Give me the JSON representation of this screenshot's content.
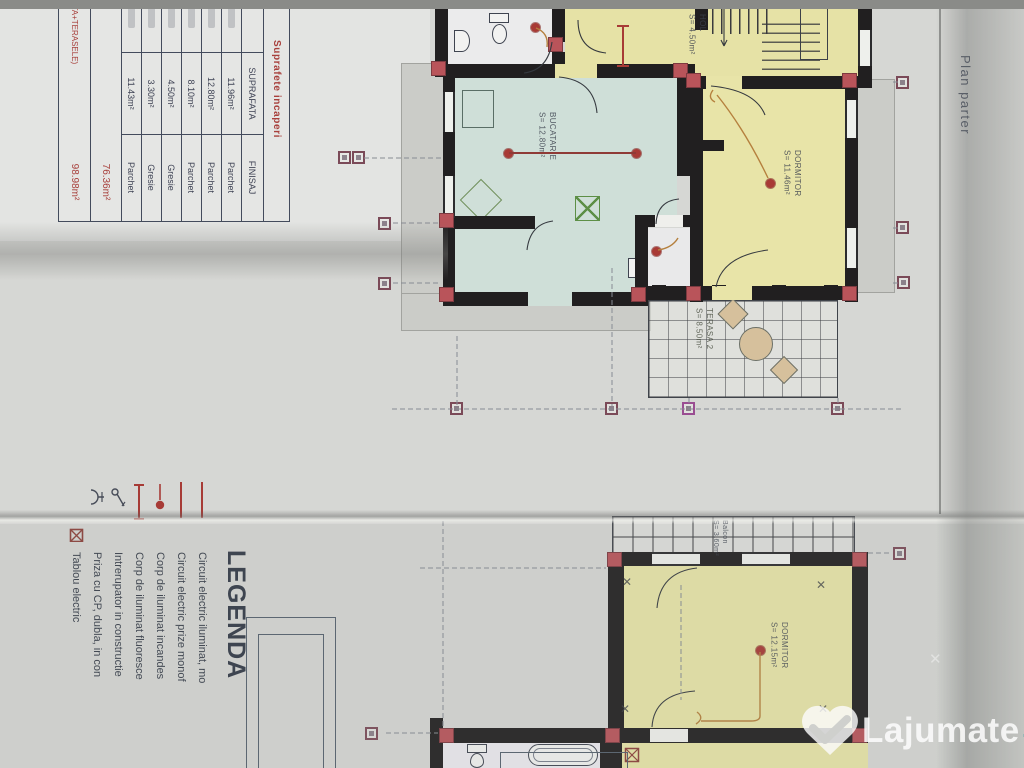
{
  "watermark": {
    "brand": "Lajumate",
    "tld": ".ro"
  },
  "fold_note": "Plan parter",
  "legend": {
    "title": "LEGENDA",
    "items": [
      {
        "icon": "circuit-line-icon",
        "label": "Circuit electric iluminat, mo"
      },
      {
        "icon": "circuit-line-icon",
        "label": "Circuit electric prize monof"
      },
      {
        "icon": "incandescent-lamp-icon",
        "label": "Corp de iluminat incandes"
      },
      {
        "icon": "fluorescent-lamp-icon",
        "label": "Corp de iluminat fluoresce"
      },
      {
        "icon": "switch-icon",
        "label": "Intrerupator in constructie"
      },
      {
        "icon": "socket-icon",
        "label": "Priza cu CP, dubla, in con"
      },
      {
        "icon": "electric-panel-icon",
        "label": "Tablou electric"
      }
    ]
  },
  "areas_table": {
    "title": "Suprafete incaperi",
    "columns": [
      "SUPRAFATA",
      "FINISAJ"
    ],
    "rows": [
      {
        "suprafata": "11.96m²",
        "finisaj": "Parchet"
      },
      {
        "suprafata": "12.80m²",
        "finisaj": "Parchet"
      },
      {
        "suprafata": "8.10m²",
        "finisaj": "Parchet"
      },
      {
        "suprafata": "4.50m²",
        "finisaj": "Gresie"
      },
      {
        "suprafata": "3.30m²",
        "finisaj": "Gresie"
      },
      {
        "suprafata": "11.43m²",
        "finisaj": "Parchet"
      }
    ],
    "totals": [
      {
        "label": "UTILA",
        "value": "76.36m²"
      },
      {
        "label": "(CONSTRUITA+TERASELE)",
        "value": "98.98m²"
      }
    ]
  },
  "plan_parter": {
    "rooms": {
      "hol": {
        "label": "HOL\nS= 4.50m²"
      },
      "bucatarie": {
        "label": "BUCATARIE\nS= 12.80m²"
      },
      "dormitor": {
        "label": "DORMITOR\nS= 11.46m²"
      },
      "terasa": {
        "label": "TERASA 2\nS= 8.50m²"
      }
    }
  },
  "plan_etaj": {
    "rooms": {
      "balcon": {
        "label": "Balcon\nS= 3.60m²"
      },
      "dormitor": {
        "label": "DORMITOR\nS= 12.15m²"
      }
    }
  }
}
